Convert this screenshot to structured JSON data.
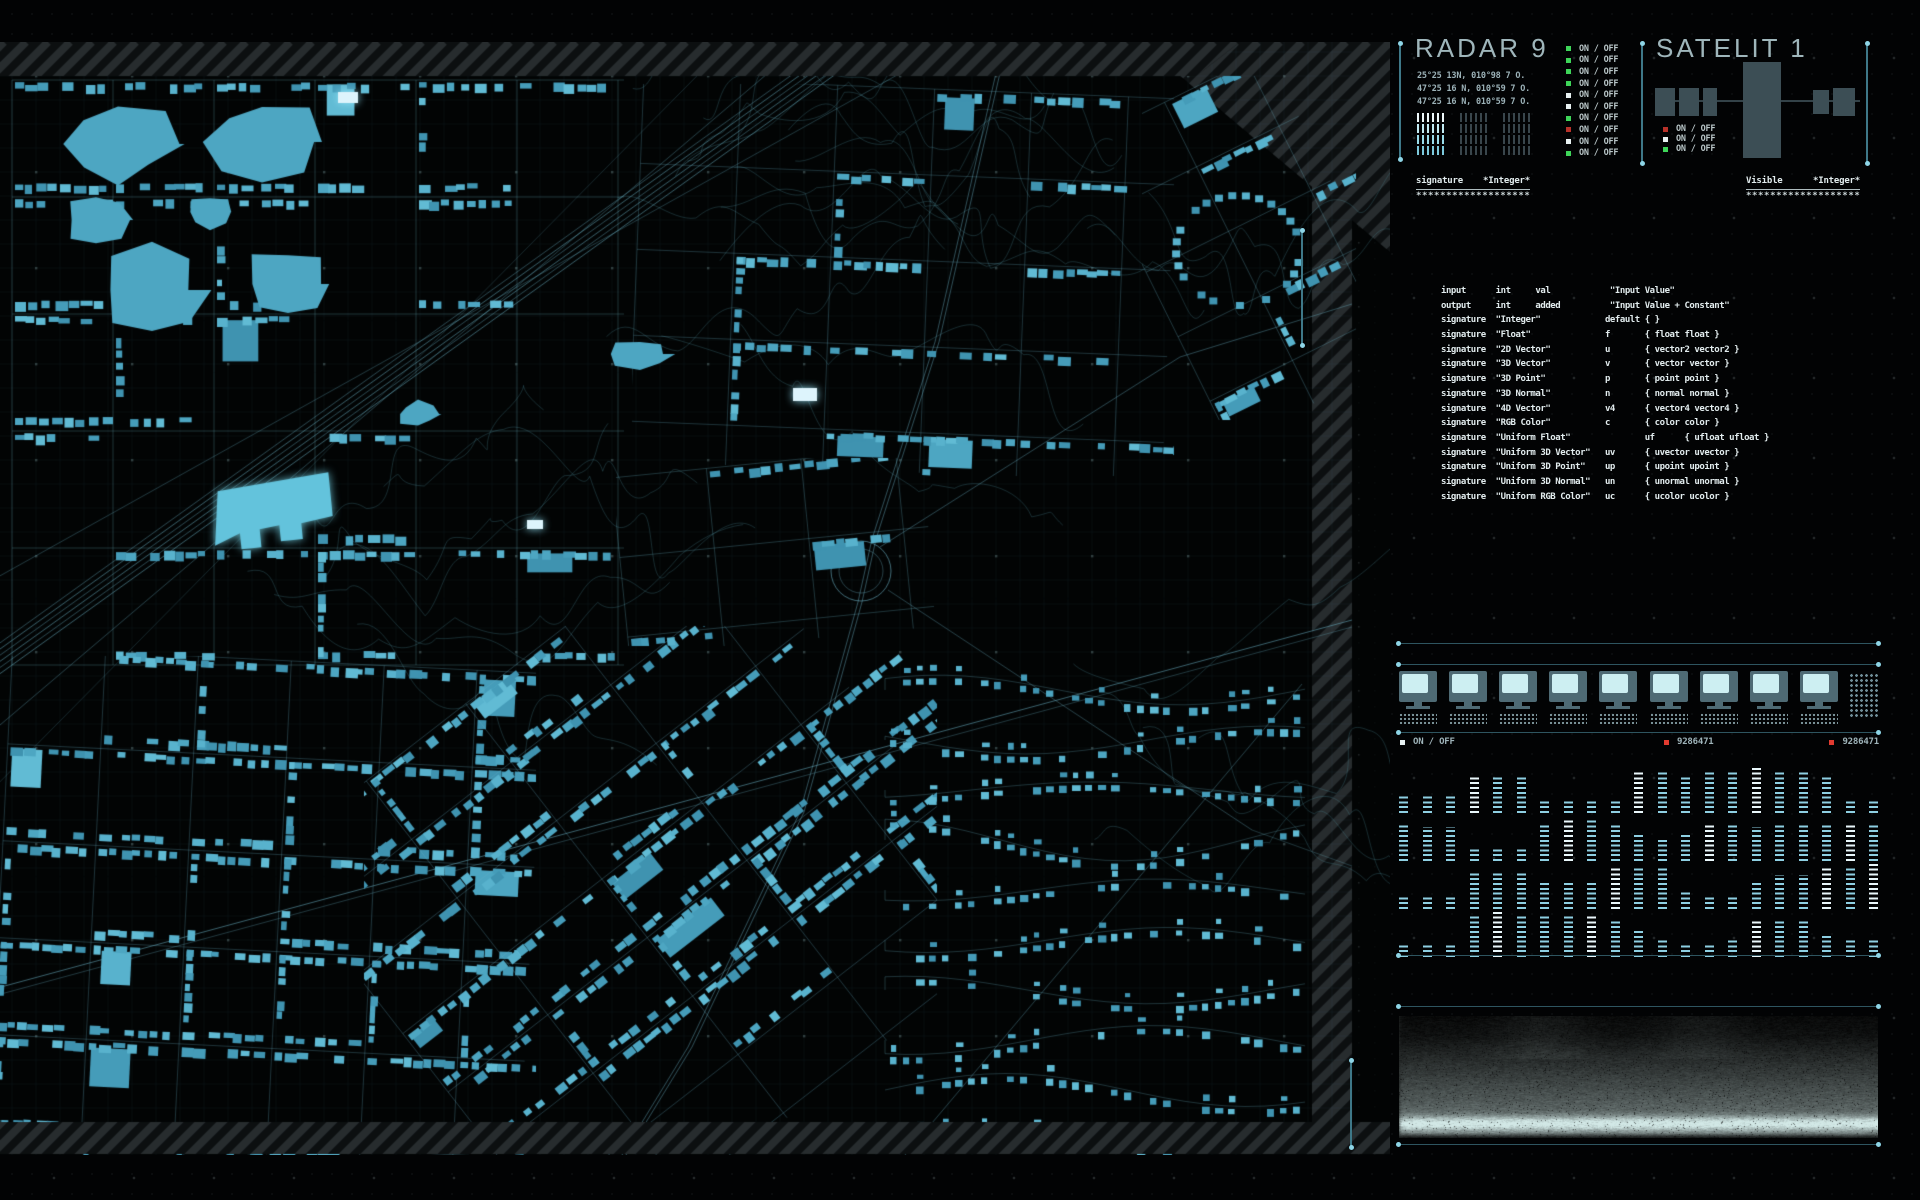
{
  "radar": {
    "title": "RADAR 9",
    "coords": [
      "25°25 13N, 010°98 7 O.",
      "47°25 16 N, 010°59 7 O.",
      "47°25 16 N, 010°59 7 O."
    ],
    "onoff_label": "ON / OFF",
    "toggles": [
      "green",
      "green",
      "green",
      "green",
      "white",
      "white",
      "green",
      "red",
      "white",
      "green"
    ],
    "combs": [
      {
        "state": "active"
      },
      {
        "state": "idle"
      },
      {
        "state": "idle"
      }
    ]
  },
  "satellite": {
    "title": "SATELIT 1",
    "onoff_label": "ON / OFF",
    "toggles": [
      "red",
      "white",
      "green"
    ]
  },
  "headers": {
    "left": {
      "label": "signature",
      "value": "*Integer*"
    },
    "right": {
      "label": "Visible",
      "value": "*Integer*"
    },
    "stars": "************************"
  },
  "table": {
    "rows": [
      "input      int     val            \"Input Value\"",
      "output     int     added          \"Input Value + Constant\"",
      "signature  \"Integer\"             default { }",
      "signature  \"Float\"               f       { float float }",
      "signature  \"2D Vector\"           u       { vector2 vector2 }",
      "signature  \"3D Vector\"           v       { vector vector }",
      "signature  \"3D Point\"            p       { point point }",
      "signature  \"3D Normal\"           n       { normal normal }",
      "signature  \"4D Vector\"           v4      { vector4 vector4 }",
      "signature  \"RGB Color\"           c       { color color }",
      "signature  \"Uniform Float\"               uf      { ufloat ufloat }",
      "signature  \"Uniform 3D Vector\"   uv      { uvector uvector }",
      "signature  \"Uniform 3D Point\"    up      { upoint upoint }",
      "signature  \"Uniform 3D Normal\"   un      { unormal unormal }",
      "signature  \"Uniform RGB Color\"   uc      { ucolor ucolor }"
    ]
  },
  "monitors": {
    "count": 9,
    "status_label": "ON / OFF",
    "code1": "9286471",
    "code2": "9286471"
  },
  "meters": {
    "rows": [
      [
        4,
        4,
        4,
        8,
        8,
        8,
        3,
        3,
        3,
        3,
        9,
        9,
        8,
        9,
        9,
        10,
        9,
        9,
        8,
        3,
        3
      ],
      [
        8,
        7,
        7,
        3,
        3,
        3,
        8,
        9,
        9,
        8,
        6,
        5,
        6,
        8,
        8,
        7,
        8,
        8,
        8,
        8,
        8
      ],
      [
        3,
        3,
        3,
        8,
        8,
        8,
        6,
        6,
        6,
        9,
        9,
        9,
        4,
        3,
        3,
        6,
        7,
        7,
        9,
        9,
        10
      ],
      [
        3,
        3,
        3,
        9,
        10,
        9,
        9,
        9,
        9,
        8,
        6,
        4,
        3,
        3,
        4,
        8,
        8,
        8,
        5,
        4,
        4
      ]
    ],
    "bright": [
      [
        3,
        10,
        15
      ],
      [
        7,
        13,
        19
      ],
      [
        9,
        18,
        20
      ],
      [
        4,
        8,
        15
      ]
    ]
  },
  "colors": {
    "accent": "#8ed5e6",
    "building": "#4da6c2",
    "green": "#3ed659",
    "red": "#b8322a",
    "white": "#e8f2f2",
    "status_red": "#e23b30",
    "panel_gray": "#3c4e55",
    "comb_bright": [
      "#eef8fa",
      "#c2ebf3",
      "#9adcea",
      "#7cc9dc"
    ],
    "comb_dim": [
      "#39464c",
      "#39464c",
      "#39464c",
      "#39464c"
    ]
  }
}
